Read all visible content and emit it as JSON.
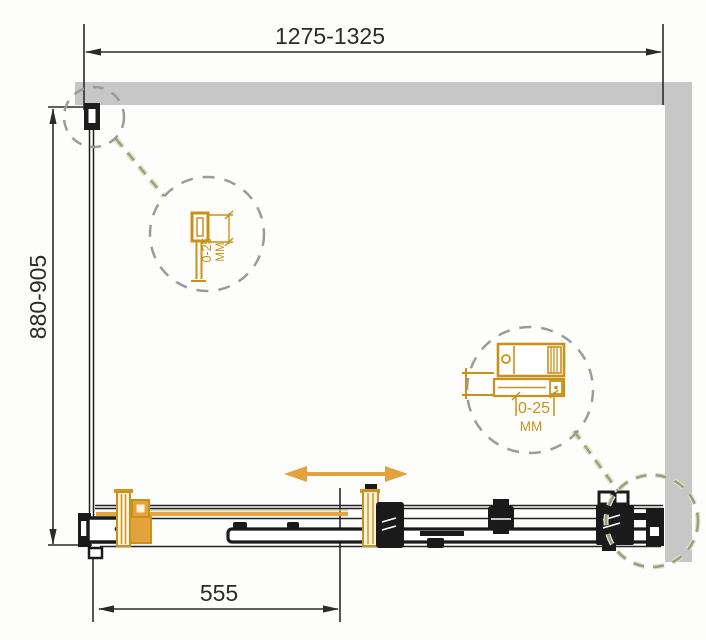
{
  "diagram": {
    "title": "shower-enclosure-dimension-drawing",
    "dimensions": {
      "width_range": "1275-1325",
      "height_range": "880-905",
      "door_opening": "555"
    },
    "details": {
      "wall_profile_adjustment": {
        "value": "0-25",
        "unit": "MM"
      },
      "roller_adjustment": {
        "value": "0-25",
        "unit": "MM"
      }
    },
    "icons": {
      "slide_direction": "double-arrow-icon",
      "callouts": "dashed-detail-circle"
    },
    "colors": {
      "wall_gray": "#C7C7C7",
      "line_black": "#1E1E1E",
      "accent_orange": "#D6951F",
      "arrow_orange": "#E3A23B",
      "dash_gray": "#9B9B9B",
      "leader_olive": "#DFE8AC"
    }
  }
}
